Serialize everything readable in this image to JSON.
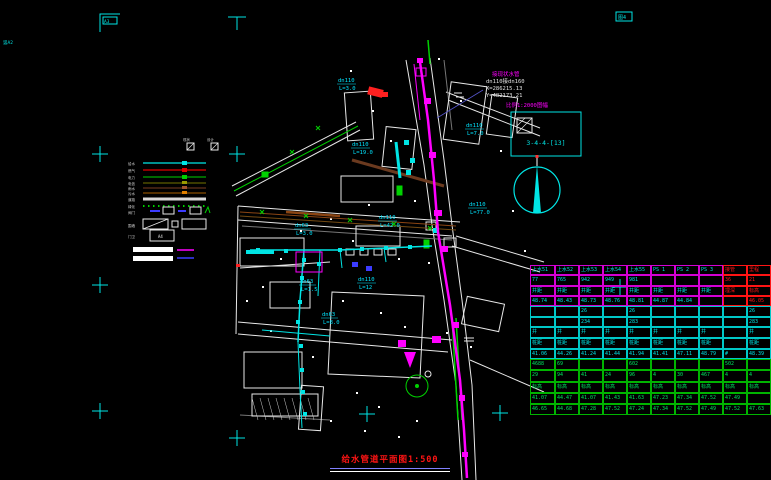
{
  "colors": {
    "cyan": "#00e5e5",
    "magenta": "#ff00ff",
    "green": "#00d200",
    "red": "#ff1414",
    "white": "#ffffff",
    "blue": "#3c3cff",
    "brown": "#8b4513",
    "orange": "#e08000",
    "gray": "#9c9c9c"
  },
  "title": {
    "text": "给水管道平面图",
    "scale": "1:500"
  },
  "stamps": {
    "top_left": "A3",
    "top_right": "图4",
    "left_edge": "竖A2"
  },
  "inset": {
    "scale_note": "比例1:2000图幅",
    "sheet_ref": "3-4-4-[13]"
  },
  "coord_note": {
    "l1": "接现状水管",
    "l2": "dn110接dn160",
    "l3": "X=286215.13",
    "l4": "Y=482173.21"
  },
  "pipe_labels": {
    "l1": {
      "text": "dn110",
      "sub": "L=3.0"
    },
    "l2": {
      "text": "dn110",
      "sub": "L=19.0"
    },
    "l3": {
      "text": "dn110",
      "sub": "L=7.0"
    },
    "l4": {
      "text": "dn110",
      "sub": "L=77.0"
    },
    "l5": {
      "text": "dn110",
      "sub": "L=42.0"
    },
    "l6": {
      "text": "dn63",
      "sub": "L=3.0"
    },
    "l7": {
      "text": "dn63",
      "sub": "L=1.5"
    },
    "l8": {
      "text": "dn110",
      "sub": "L=12"
    },
    "l9": {
      "text": "dn63",
      "sub": "L=8.0"
    }
  },
  "legend": {
    "header_left": "现状",
    "header_right": "设计",
    "lines": [
      {
        "label": "给水",
        "color": "#00e5e5"
      },
      {
        "label": "燃气",
        "color": "#e00000"
      },
      {
        "label": "电力",
        "color": "#00d000"
      },
      {
        "label": "电信",
        "color": "#9a9a00"
      },
      {
        "label": "雨水",
        "color": "#a0522d"
      },
      {
        "label": "污水",
        "color": "#e08000"
      },
      {
        "label": "道路",
        "color": "#d8d8d8"
      },
      {
        "label": "绿化",
        "color": "#00d000"
      }
    ],
    "symbol_row_label": "阀门",
    "frame_row_label": "围墙",
    "box_row_label": "门卫",
    "box_label": "A4"
  },
  "table": {
    "sections": [
      {
        "border": "#d400d4",
        "text": "#00e5e5",
        "red_cols": [
          8,
          9
        ],
        "row_h": 10.3,
        "rows": [
          [
            "上水51",
            "上水52",
            "上水53",
            "上水54",
            "上水55",
            "PS 1",
            "PS 2",
            "PS 3",
            "接管",
            "里程"
          ],
          [
            "77",
            "765",
            "942",
            "949",
            "981",
            "",
            "",
            "",
            "36",
            "21"
          ],
          [
            "井距",
            "井距",
            "井距",
            "井距",
            "井距",
            "井距",
            "井距",
            "井距",
            "埋深",
            "标高"
          ],
          [
            "48.74",
            "48.43",
            "48.73",
            "48.76",
            "48.81",
            "44.87",
            "44.84",
            "",
            "",
            "46.05"
          ]
        ]
      },
      {
        "border": "#00c8c8",
        "text": "#00e5e5",
        "red_cols": [],
        "row_h": 10.6,
        "rows": [
          [
            "",
            "",
            "26",
            "",
            "26",
            "",
            "",
            "",
            "",
            "26"
          ],
          [
            "",
            "",
            "234",
            "",
            "283",
            "",
            "",
            "",
            "",
            "283"
          ],
          [
            "井",
            "井",
            "井",
            "井",
            "井",
            "井",
            "井",
            "井",
            "",
            "井"
          ],
          [
            "桩距",
            "桩距",
            "桩距",
            "桩距",
            "桩距",
            "桩距",
            "桩距",
            "桩距",
            "",
            "桩距"
          ],
          [
            "41.06",
            "44.26",
            "41.24",
            "41.44",
            "41.94",
            "41.41",
            "47.11",
            "48.79",
            "#",
            "48.39"
          ]
        ]
      },
      {
        "border": "#00b400",
        "text": "#00e560",
        "red_cols": [],
        "row_h": 11.2,
        "rows": [
          [
            "4688",
            "69",
            "",
            "",
            "602",
            "",
            "",
            "",
            "502",
            ""
          ],
          [
            "29",
            "94",
            "41",
            "24",
            "96",
            "4",
            "30",
            "467",
            "4",
            "4"
          ],
          [
            "标高",
            "标高",
            "标高",
            "标高",
            "标高",
            "标高",
            "标高",
            "标高",
            "标高",
            "标高"
          ],
          [
            "41.07",
            "44.47",
            "41.07",
            "41.43",
            "41.63",
            "47.23",
            "47.34",
            "47.52",
            "47.49",
            ""
          ],
          [
            "46.65",
            "44.68",
            "47.28",
            "47.52",
            "47.24",
            "47.34",
            "47.52",
            "47.49",
            "47.52",
            "47.63"
          ]
        ]
      }
    ]
  }
}
